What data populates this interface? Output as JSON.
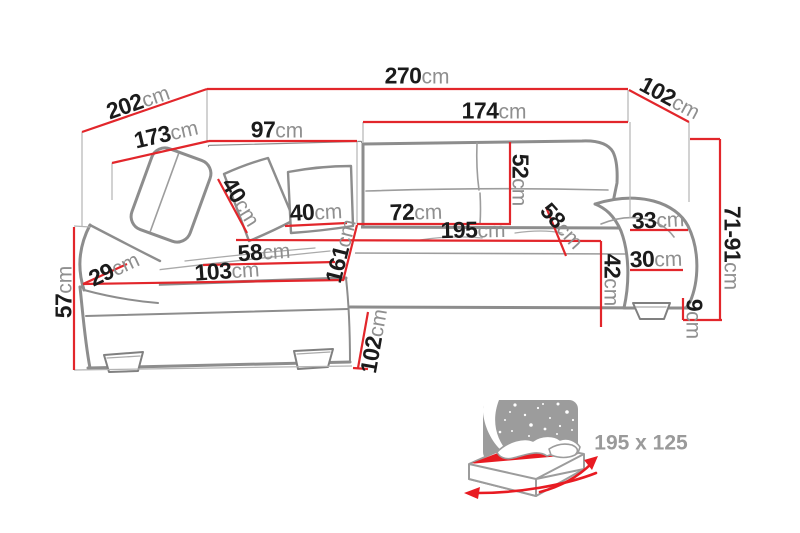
{
  "colors": {
    "red": "#e2262b",
    "sofa": "#8d8d8d",
    "num": "#1b1b1b",
    "unit": "#8f8f8f",
    "panel": "#9c9c9c",
    "mattress": "#e81b22",
    "bed_text": "#9a9a9a"
  },
  "dims": {
    "d270": {
      "value": "270",
      "unit": "cm"
    },
    "d202": {
      "value": "202",
      "unit": "cm"
    },
    "d102_top": {
      "value": "102",
      "unit": "cm"
    },
    "d174": {
      "value": "174",
      "unit": "cm"
    },
    "d173": {
      "value": "173",
      "unit": "cm"
    },
    "d97": {
      "value": "97",
      "unit": "cm"
    },
    "d52": {
      "value": "52",
      "unit": "cm"
    },
    "d40_side": {
      "value": "40",
      "unit": "cm"
    },
    "d40_front": {
      "value": "40",
      "unit": "cm"
    },
    "d72": {
      "value": "72",
      "unit": "cm"
    },
    "d195": {
      "value": "195",
      "unit": "cm"
    },
    "d58_right": {
      "value": "58",
      "unit": "cm"
    },
    "d33": {
      "value": "33",
      "unit": "cm"
    },
    "d30": {
      "value": "30",
      "unit": "cm"
    },
    "d42": {
      "value": "42",
      "unit": "cm"
    },
    "d161": {
      "value": "161",
      "unit": "cm"
    },
    "d58_seat": {
      "value": "58",
      "unit": "cm"
    },
    "d103": {
      "value": "103",
      "unit": "cm"
    },
    "d29": {
      "value": "29",
      "unit": "cm"
    },
    "d57": {
      "value": "57",
      "unit": "cm"
    },
    "d102_front": {
      "value": "102",
      "unit": "cm"
    },
    "d71_91": {
      "value": "71-91",
      "unit": "cm"
    },
    "d9": {
      "value": "9",
      "unit": "cm"
    }
  },
  "bed": {
    "size_label": "195 x 125"
  }
}
